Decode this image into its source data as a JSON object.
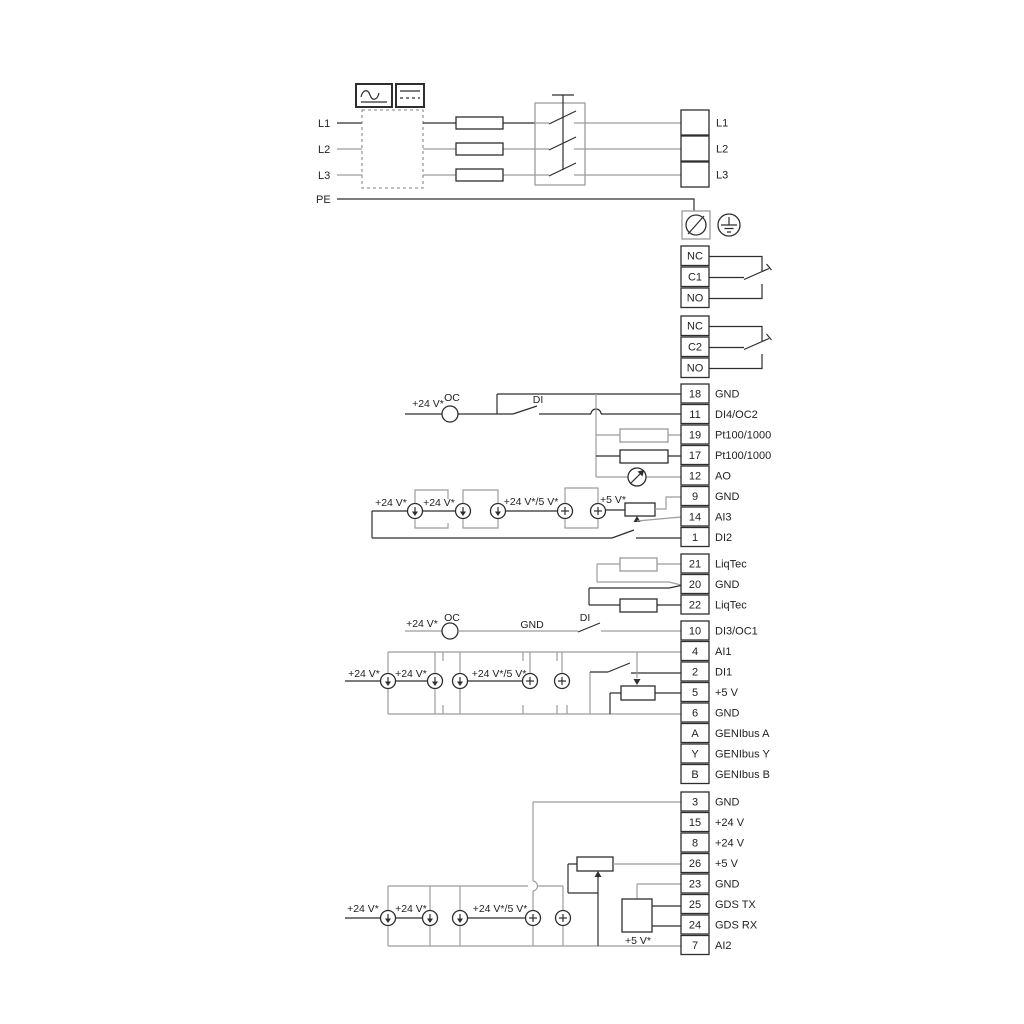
{
  "diagram": {
    "title": "Terminal wiring diagram",
    "colors": {
      "wire_dark": "#2e2e2e",
      "wire_grey": "#9c9c9c",
      "text": "#222222",
      "background": "#ffffff"
    },
    "power_inputs": [
      "L1",
      "L2",
      "L3",
      "PE"
    ],
    "power_outputs": [
      "L1",
      "L2",
      "L3"
    ],
    "relays": [
      {
        "terminals": [
          "NC",
          "C1",
          "NO"
        ]
      },
      {
        "terminals": [
          "NC",
          "C2",
          "NO"
        ]
      }
    ],
    "terminal_groups": [
      {
        "rows": [
          {
            "num": "18",
            "label": "GND"
          },
          {
            "num": "11",
            "label": "DI4/OC2"
          },
          {
            "num": "19",
            "label": "Pt100/1000"
          },
          {
            "num": "17",
            "label": "Pt100/1000"
          },
          {
            "num": "12",
            "label": "AO"
          },
          {
            "num": "9",
            "label": "GND"
          },
          {
            "num": "14",
            "label": "AI3"
          },
          {
            "num": "1",
            "label": "DI2"
          }
        ]
      },
      {
        "rows": [
          {
            "num": "21",
            "label": "LiqTec"
          },
          {
            "num": "20",
            "label": "GND"
          },
          {
            "num": "22",
            "label": "LiqTec"
          }
        ]
      },
      {
        "rows": [
          {
            "num": "10",
            "label": "DI3/OC1"
          },
          {
            "num": "4",
            "label": "AI1"
          },
          {
            "num": "2",
            "label": "DI1"
          },
          {
            "num": "5",
            "label": "+5 V"
          },
          {
            "num": "6",
            "label": "GND"
          },
          {
            "num": "A",
            "label": "GENIbus A"
          },
          {
            "num": "Y",
            "label": "GENIbus Y"
          },
          {
            "num": "B",
            "label": "GENIbus B"
          }
        ]
      },
      {
        "rows": [
          {
            "num": "3",
            "label": "GND"
          },
          {
            "num": "15",
            "label": "+24 V"
          },
          {
            "num": "8",
            "label": "+24 V"
          },
          {
            "num": "26",
            "label": "+5 V"
          },
          {
            "num": "23",
            "label": "GND"
          },
          {
            "num": "25",
            "label": "GDS TX"
          },
          {
            "num": "24",
            "label": "GDS RX"
          },
          {
            "num": "7",
            "label": "AI2"
          }
        ]
      }
    ],
    "annotations": {
      "v24": "+24 V*",
      "v24_5": "+24 V*/5 V*",
      "v5": "+5 V*",
      "oc": "OC",
      "di": "DI",
      "gnd": "GND"
    }
  }
}
